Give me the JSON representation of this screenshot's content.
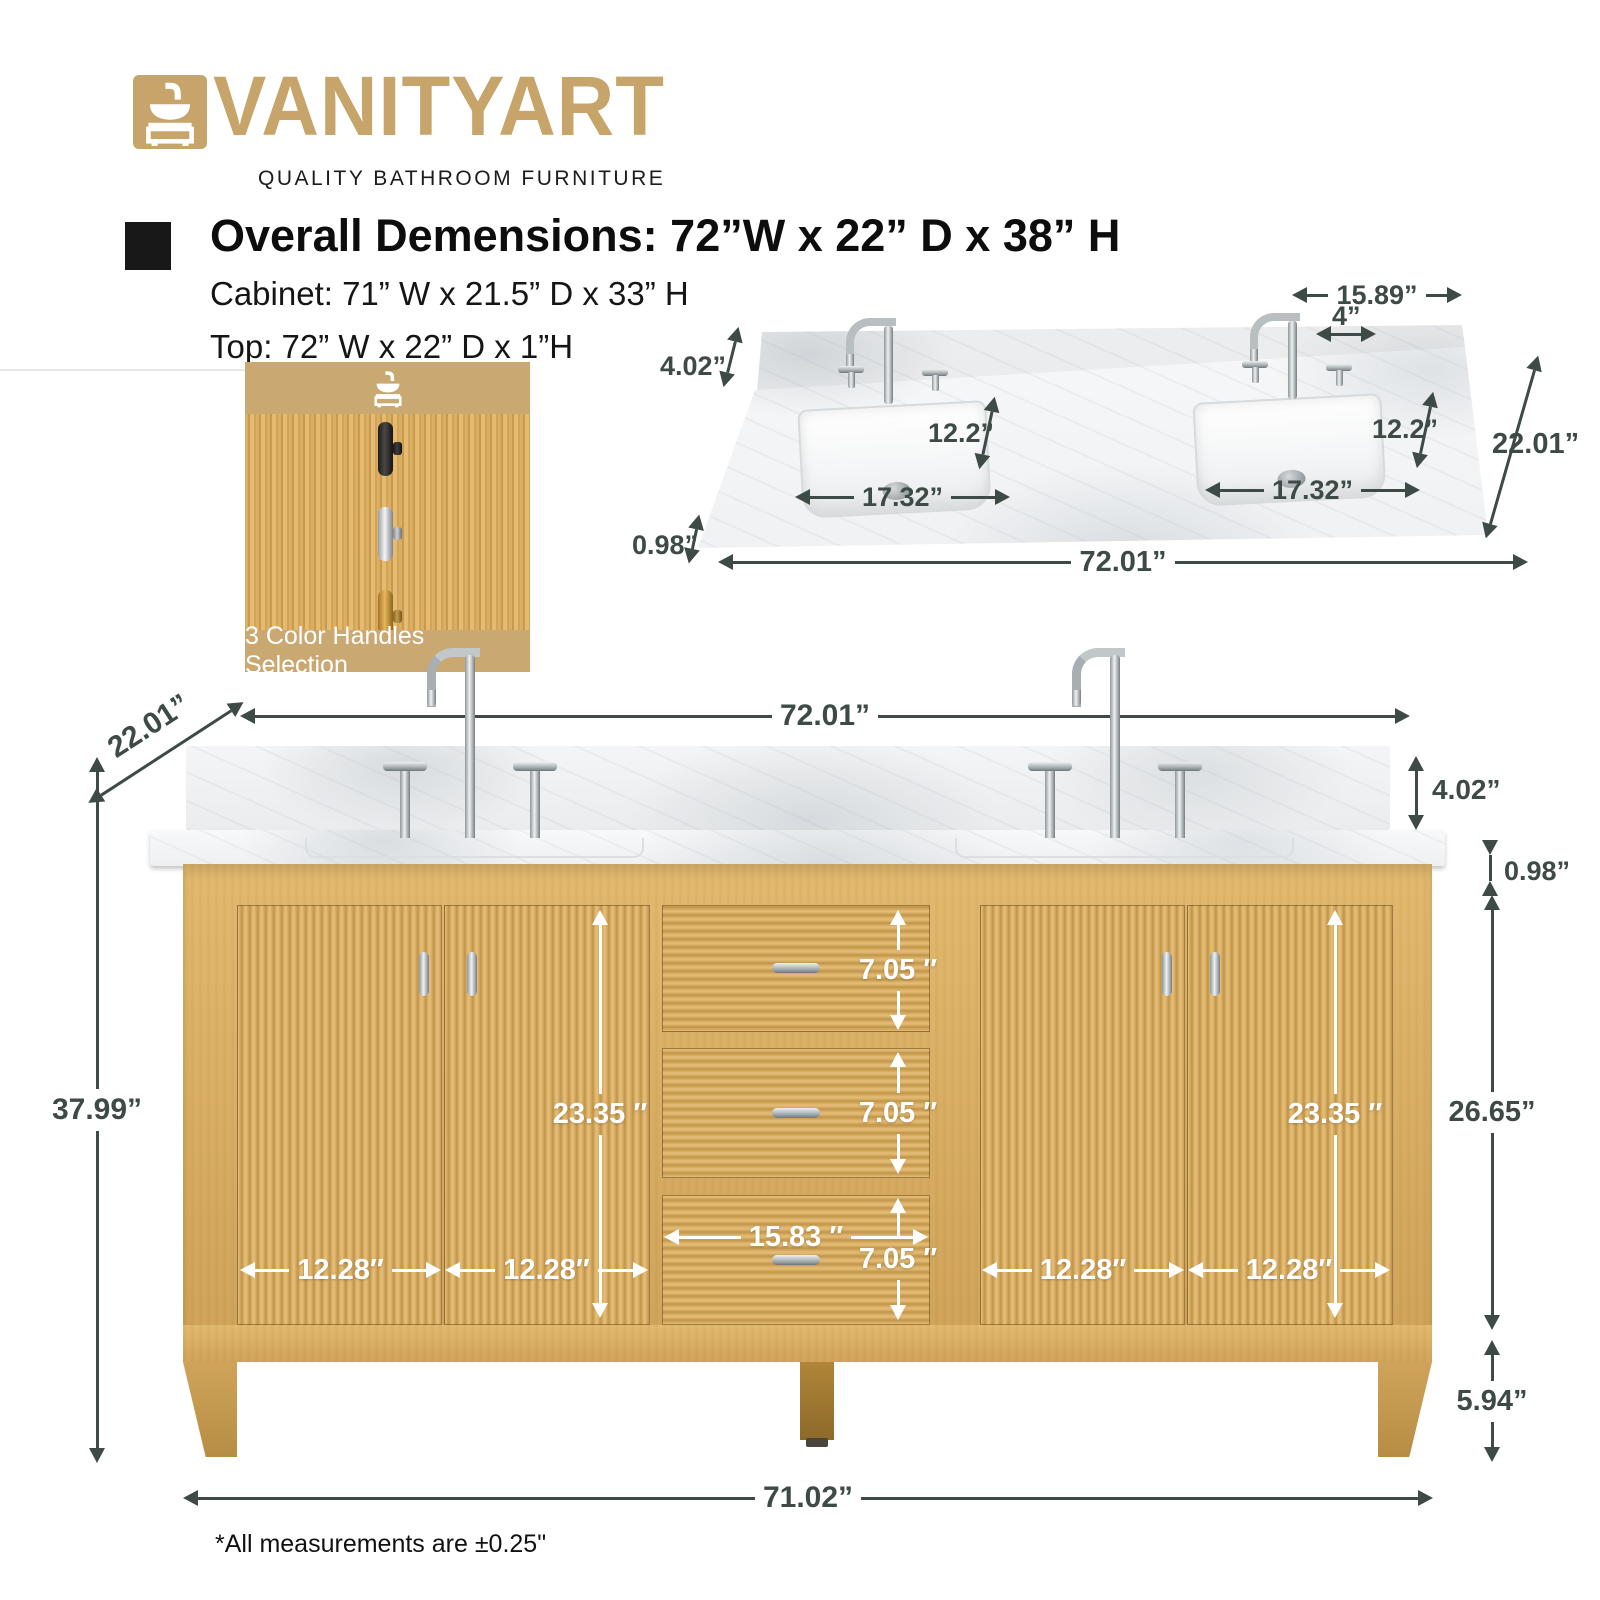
{
  "brand": {
    "name": "VANITYART",
    "tagline": "QUALITY BATHROOM FURNITURE"
  },
  "specs": {
    "overall": "Overall Demensions: 72”W x 22” D x 38” H",
    "cabinet": "Cabinet: 71” W x 21.5” D x 33” H",
    "top": "Top: 72” W x 22” D x 1”H"
  },
  "handles_card": {
    "caption": "3 Color Handles Selection",
    "options": [
      "black-handle",
      "chrome-handle",
      "gold-handle"
    ]
  },
  "top_view": {
    "dims": {
      "back_width": "15.89”",
      "faucet_spread": "4”",
      "backsplash_height": "4.02”",
      "sink_depth_left": "12.2”",
      "sink_depth_right": "12.2”",
      "counter_depth": "22.01”",
      "sink_width_left": "17.32”",
      "sink_width_right": "17.32”",
      "counter_thickness": "0.98”",
      "counter_width": "72.01”"
    }
  },
  "front_view": {
    "dims": {
      "counter_width": "72.01”",
      "counter_depth": "22.01”",
      "overall_height": "37.99”",
      "backsplash_height": "4.02”",
      "counter_thickness": "0.98”",
      "door_height_left": "23.35 ″",
      "door_height_right": "23.35 ″",
      "drawer_height_1": "7.05 ″",
      "drawer_height_2": "7.05 ″",
      "drawer_height_3": "7.05 ″",
      "drawer_width": "15.83 ″",
      "door_width_1": "12.28″",
      "door_width_2": "12.28″",
      "door_width_3": "12.28″",
      "door_width_4": "12.28″",
      "cabinet_height": "26.65”",
      "leg_height": "5.94”",
      "base_width": "71.02”"
    }
  },
  "footnote": "*All measurements are ±0.25\""
}
